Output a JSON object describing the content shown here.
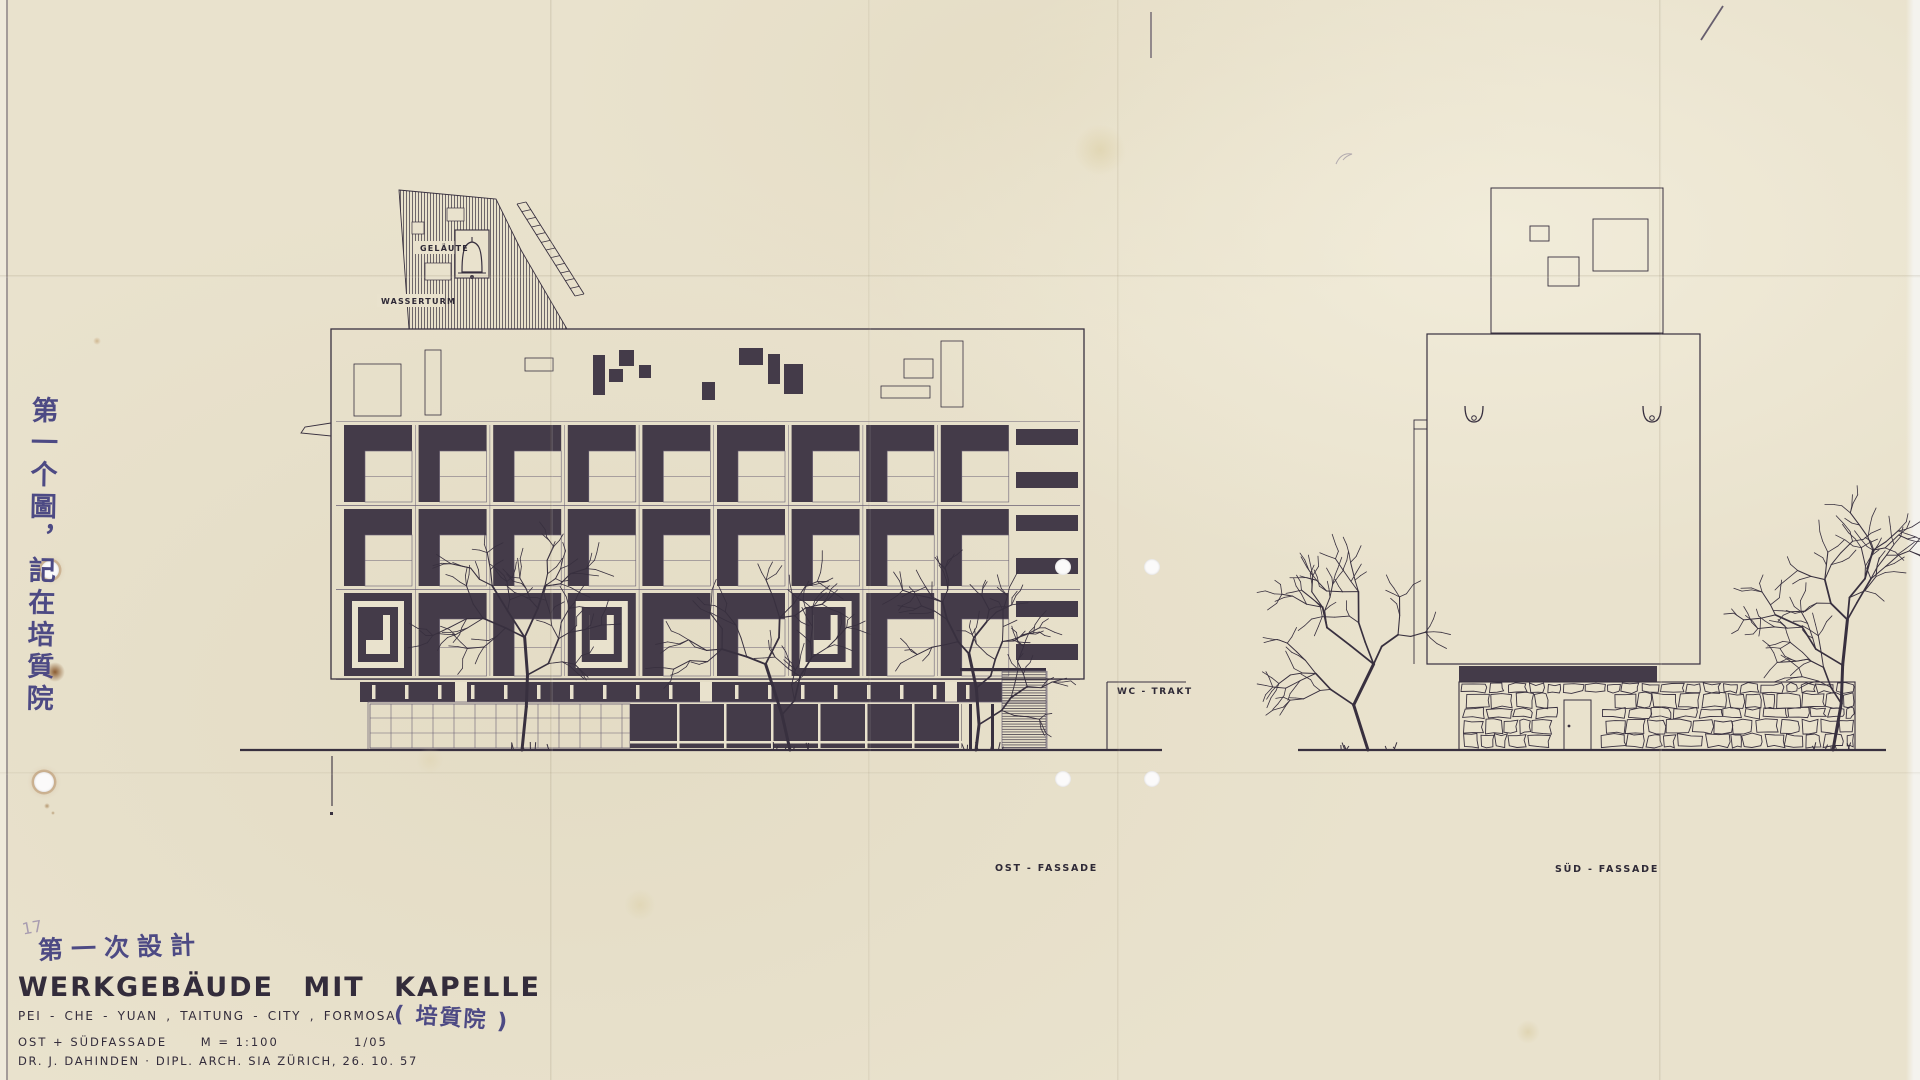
{
  "document": {
    "pencil_number": "17",
    "annotation_top": "第一次設計",
    "title": "WERKGEBÄUDE MIT KAPELLE",
    "subtitle": "PEI - CHE - YUAN , TAITUNG - CITY , FORMOSA",
    "subtitle_handwritten": "( 培質院 )",
    "facades_line": "OST + SÜDFASSADE",
    "scale": "M = 1:100",
    "sheet_number": "1/05",
    "author_line": "DR. J. DAHINDEN  ·  DIPL. ARCH. SIA  ZÜRICH, 26. 10. 57",
    "annotation_side": "第一个圖，記在培質院"
  },
  "labels_text": {
    "gelaeute": "GELÄUTE",
    "wasserturm": "WASSERTURM",
    "wc_trakt": "WC - TRAKT",
    "ost_fassade": "OST - FASSADE",
    "sued_fassade": "SÜD - FASSADE"
  },
  "label_pos": [
    {
      "id": "gelaeute",
      "x": 420,
      "y": 251,
      "fs": 8,
      "ls": 1.2
    },
    {
      "id": "wasserturm",
      "x": 381,
      "y": 304,
      "fs": 8,
      "ls": 1.2
    },
    {
      "id": "wc_trakt",
      "x": 1117,
      "y": 694,
      "fs": 9,
      "ls": 1.6
    },
    {
      "id": "ost_fassade",
      "x": 995,
      "y": 871,
      "fs": 9.5,
      "ls": 1.8
    },
    {
      "id": "sued_fassade",
      "x": 1555,
      "y": 872,
      "fs": 9.5,
      "ls": 1.8
    }
  ],
  "colors": {
    "paper": "#e9e2cd",
    "ink": "#38303f",
    "ink_fill": "#443b49",
    "hairline": "#6a6175",
    "label": "#2e2936",
    "handwriting": "#4d4a84",
    "pencil": "#a89cb0",
    "rust": "#7a4416"
  },
  "drawing": {
    "east": {
      "facade": [
        331,
        329,
        753,
        350
      ],
      "attic_outline": [
        [
          354,
          364,
          47,
          52
        ],
        [
          425,
          350,
          16,
          65
        ],
        [
          525,
          358,
          28,
          13
        ],
        [
          881,
          386,
          49,
          12
        ],
        [
          904,
          359,
          29,
          19
        ],
        [
          941,
          341,
          22,
          66
        ]
      ],
      "attic_filled": [
        [
          593,
          355,
          12,
          40
        ],
        [
          619,
          350,
          15,
          16
        ],
        [
          609,
          369,
          14,
          13
        ],
        [
          639,
          365,
          12,
          13
        ],
        [
          702,
          382,
          13,
          18
        ],
        [
          739,
          348,
          24,
          17
        ],
        [
          768,
          354,
          12,
          30
        ],
        [
          784,
          364,
          19,
          30
        ]
      ],
      "grid": {
        "x0": 344,
        "pitch": 74.6,
        "cell_w": 68,
        "bar_t": 26,
        "bar_l": 21,
        "cols": 9,
        "rows": [
          {
            "y": 425,
            "h": 77,
            "type": "gamma"
          },
          {
            "y": 509,
            "h": 77,
            "type": "gamma"
          },
          {
            "y": 593,
            "h": 83,
            "type": "mixed",
            "concentric": [
              0,
              3,
              6
            ]
          }
        ]
      },
      "right_strip": {
        "x": 1016,
        "w": 62,
        "bar_h": 16,
        "bars_y": [
          429,
          472,
          515,
          558,
          601,
          644
        ]
      },
      "spandrel": {
        "x": 360,
        "y": 682,
        "w": 642,
        "h": 20,
        "slit_step": 33,
        "wide_gaps": [
          455,
          700,
          945
        ]
      },
      "ground_floor": {
        "y": 702,
        "h": 48,
        "glazing": {
          "x": 370,
          "w": 260,
          "v_step": 21,
          "h_lines": [
            718,
            733
          ]
        },
        "dark_front": {
          "x": 630,
          "w": 332,
          "m_step": 47,
          "sill_y": 741
        },
        "posts": [
          969,
          991
        ],
        "hatched": [
          1002,
          671,
          44,
          77
        ],
        "right_edge": 1047
      },
      "tower": {
        "poly": [
          [
            399,
            190
          ],
          [
            496,
            199
          ],
          [
            521,
            250
          ],
          [
            567,
            329
          ],
          [
            409,
            329
          ]
        ],
        "cutouts": [
          [
            412,
            222,
            12,
            12
          ],
          [
            447,
            208,
            17,
            13
          ],
          [
            425,
            263,
            26,
            17
          ]
        ],
        "bell_box": [
          455,
          230,
          34,
          48
        ],
        "label_pads": [
          [
            414,
            241,
            52,
            13
          ],
          [
            377,
            294,
            68,
            13
          ]
        ],
        "ladder": [
          517,
          204,
          575,
          296,
          9,
          12
        ],
        "fin": [
          [
            331,
            423
          ],
          [
            305,
            427
          ],
          [
            301,
            433
          ],
          [
            331,
            436
          ]
        ]
      },
      "annex": {
        "x": 1107,
        "top": 682,
        "x2": 1186
      },
      "ground": [
        240,
        1162,
        750
      ],
      "ref_line": [
        332,
        756,
        806
      ]
    },
    "south": {
      "roof_box": [
        1491,
        188,
        172,
        145
      ],
      "roof_squares": [
        [
          1530,
          226,
          19,
          15
        ],
        [
          1548,
          257,
          31,
          29
        ],
        [
          1593,
          219,
          55,
          52
        ]
      ],
      "body": [
        1427,
        334,
        273,
        330
      ],
      "left_line": [
        1414,
        428,
        664
      ],
      "notch": [
        1414,
        420,
        13,
        9
      ],
      "gargoyles": [
        [
          1465,
          406
        ],
        [
          1643,
          406
        ]
      ],
      "band": [
        1459,
        666,
        198,
        16
      ],
      "wall": [
        1459,
        682,
        396,
        68
      ],
      "door": {
        "x": 1564,
        "y": 700,
        "w": 27,
        "h": 50,
        "knob": [
          1569,
          726
        ]
      },
      "ground": [
        1298,
        1886,
        750
      ]
    },
    "trees": [
      {
        "x": 522,
        "top": 592,
        "ground": 750,
        "seed": 11
      },
      {
        "x": 790,
        "top": 585,
        "ground": 750,
        "seed": 22
      },
      {
        "x": 976,
        "top": 616,
        "ground": 750,
        "seed": 33
      },
      {
        "x": 1368,
        "top": 596,
        "ground": 750,
        "seed": 44
      },
      {
        "x": 1833,
        "top": 592,
        "ground": 750,
        "seed": 55
      }
    ]
  },
  "punch_holes": [
    {
      "x": 50,
      "y": 570,
      "r": 9,
      "rust": true
    },
    {
      "x": 44,
      "y": 782,
      "r": 10,
      "rust": true
    },
    {
      "x": 1063,
      "y": 567,
      "r": 8,
      "rust": false
    },
    {
      "x": 1152,
      "y": 567,
      "r": 8,
      "rust": false
    },
    {
      "x": 1063,
      "y": 779,
      "r": 8,
      "rust": false
    },
    {
      "x": 1152,
      "y": 779,
      "r": 8,
      "rust": false
    }
  ],
  "creases": [
    {
      "o": "v",
      "p": 551,
      "s": 0.16
    },
    {
      "o": "v",
      "p": 869,
      "s": 0.1
    },
    {
      "o": "v",
      "p": 1118,
      "s": 0.12
    },
    {
      "o": "v",
      "p": 1660,
      "s": 0.16
    },
    {
      "o": "h",
      "p": 276,
      "s": 0.15
    },
    {
      "o": "h",
      "p": 773,
      "s": 0.09
    }
  ],
  "stains": [
    {
      "x": 55,
      "y": 672,
      "r": 10,
      "c": "#7a4416",
      "o": 0.85
    },
    {
      "x": 47,
      "y": 806,
      "r": 3,
      "c": "#8a5a22",
      "o": 0.55
    },
    {
      "x": 53,
      "y": 813,
      "r": 2,
      "c": "#8a5a22",
      "o": 0.5
    },
    {
      "x": 1100,
      "y": 150,
      "r": 26,
      "c": "#d9cb9d",
      "o": 0.5
    },
    {
      "x": 640,
      "y": 905,
      "r": 16,
      "c": "#d9cb9d",
      "o": 0.4
    },
    {
      "x": 1528,
      "y": 1032,
      "r": 12,
      "c": "#d4c493",
      "o": 0.45
    },
    {
      "x": 97,
      "y": 341,
      "r": 4,
      "c": "#b08448",
      "o": 0.45
    },
    {
      "x": 430,
      "y": 760,
      "r": 14,
      "c": "#ddd0a8",
      "o": 0.4
    }
  ]
}
